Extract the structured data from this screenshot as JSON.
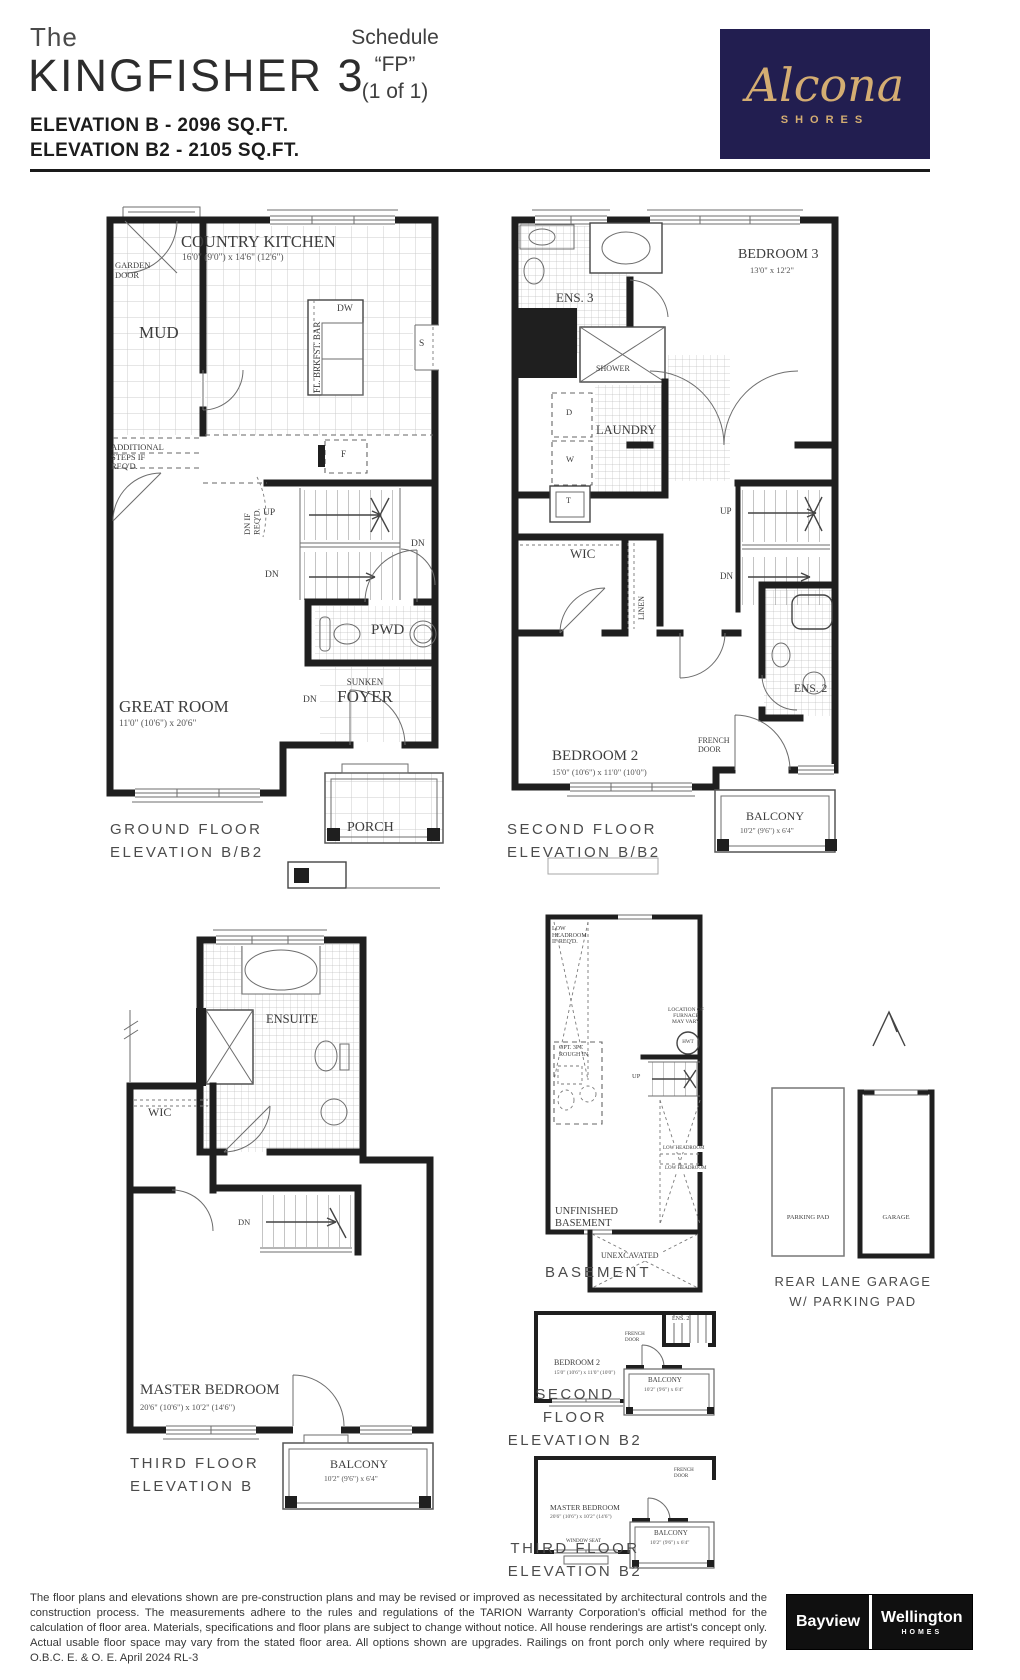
{
  "header": {
    "the": "The",
    "title": "KINGFISHER 3",
    "schedule": "Schedule “FP”\n(1 of 1)",
    "elevation_b": "ELEVATION B - 2096 SQ.FT.",
    "elevation_b2": "ELEVATION B2 - 2105 SQ.FT.",
    "logo": {
      "name": "Alcona",
      "sub": "SHORES",
      "bg_color": "#221e50",
      "gold_color": "#d4ad72"
    }
  },
  "ground": {
    "caption": "GROUND FLOOR\nELEVATION B/B2",
    "kitchen": "COUNTRY KITCHEN",
    "kitchen_dims": "16'0\" (9'0\") x 14'6\" (12'6\")",
    "garden_door": "GARDEN\nDOOR",
    "mud": "MUD",
    "add_steps": "ADDITIONAL\nSTEPS IF\nREQ'D.",
    "dn_if_reqd": "DN IF\nREQ'D.",
    "dw": "DW",
    "s": "S",
    "f": "F",
    "brkfst": "FL. BRKFST. BAR",
    "up": "UP",
    "dn": "DN",
    "dn_foyer": "DN",
    "dn_hall": "DN",
    "pwd": "PWD",
    "sunken": "SUNKEN",
    "foyer": "FOYER",
    "great": "GREAT ROOM",
    "great_dims": "11'0\" (10'6\") x 20'6\"",
    "porch": "PORCH"
  },
  "second": {
    "caption": "SECOND FLOOR\nELEVATION B/B2",
    "bedroom3": "BEDROOM 3",
    "bedroom3_dims": "13'0\" x 12'2\"",
    "ens3": "ENS. 3",
    "shower": "SHOWER",
    "laundry": "LAUNDRY",
    "d": "D",
    "w": "W",
    "t": "T",
    "wic": "WIC",
    "linen": "LINEN",
    "up": "UP",
    "dn": "DN",
    "bedroom2": "BEDROOM 2",
    "bedroom2_dims": "15'0\" (10'6\") x 11'0\" (10'0\")",
    "ens2": "ENS. 2",
    "french": "FRENCH\nDOOR",
    "balcony": "BALCONY",
    "balcony_dims": "10'2\" (9'6\") x 6'4\""
  },
  "third": {
    "caption": "THIRD FLOOR\nELEVATION B",
    "ensuite": "ENSUITE",
    "wic": "WIC",
    "dn": "DN",
    "master": "MASTER BEDROOM",
    "master_dims": "20'6\" (10'6\") x 10'2\" (14'6\")",
    "balcony": "BALCONY",
    "balcony_dims": "10'2\" (9'6\") x 6'4\""
  },
  "basement": {
    "caption": "BASEMENT",
    "low_head_reqd": "LOW\nHEADROOM\nIF REQ'D.",
    "opt_3pc": "OPT. 3PC\nROUGH IN",
    "furnace": "LOCATION OF\nFURNACE\nMAY VARY",
    "hwt": "HWT",
    "up": "UP",
    "low_head1": "LOW HEADROOM",
    "low_head2": "LOW HEADROOM",
    "unfinished": "UNFINISHED\nBASEMENT",
    "unexcavated": "UNEXCAVATED"
  },
  "garage": {
    "caption": "REAR LANE GARAGE\nW/ PARKING PAD",
    "parking": "PARKING PAD",
    "garage": "GARAGE"
  },
  "second_b2": {
    "caption": "SECOND FLOOR\nELEVATION B2",
    "bedroom2": "BEDROOM 2",
    "bedroom2_dims": "15'0\" (10'6\") x 11'0\" (10'0\")",
    "ens2": "ENS. 2",
    "french": "FRENCH\nDOOR",
    "balcony": "BALCONY",
    "balcony_dims": "10'2\" (9'6\") x 6'4\""
  },
  "third_b2": {
    "caption": "THIRD FLOOR\nELEVATION B2",
    "master": "MASTER BEDROOM",
    "master_dims": "20'6\" (10'6\") x 10'2\" (14'6\")",
    "window_seat": "WINDOW SEAT",
    "french": "FRENCH\nDOOR",
    "balcony": "BALCONY",
    "balcony_dims": "10'2\" (9'6\") x 6'4\""
  },
  "footer": {
    "disclaimer": "The floor plans and elevations shown are pre-construction plans and may be revised or improved as necessitated by architectural controls and the construction process. The measurements adhere to the rules and regulations of the TARION Warranty Corporation's official method for the calculation of floor area. Materials, specifications and floor plans are subject to change without notice. All house renderings are artist's concept only. Actual usable floor space may vary from the stated floor area. All options shown are upgrades. Railings on front porch only where required by O.B.C.  E. & O. E.  April 2024   RL-3",
    "bayview": "Bayview",
    "wellington": "Wellington",
    "homes": "HOMES"
  }
}
